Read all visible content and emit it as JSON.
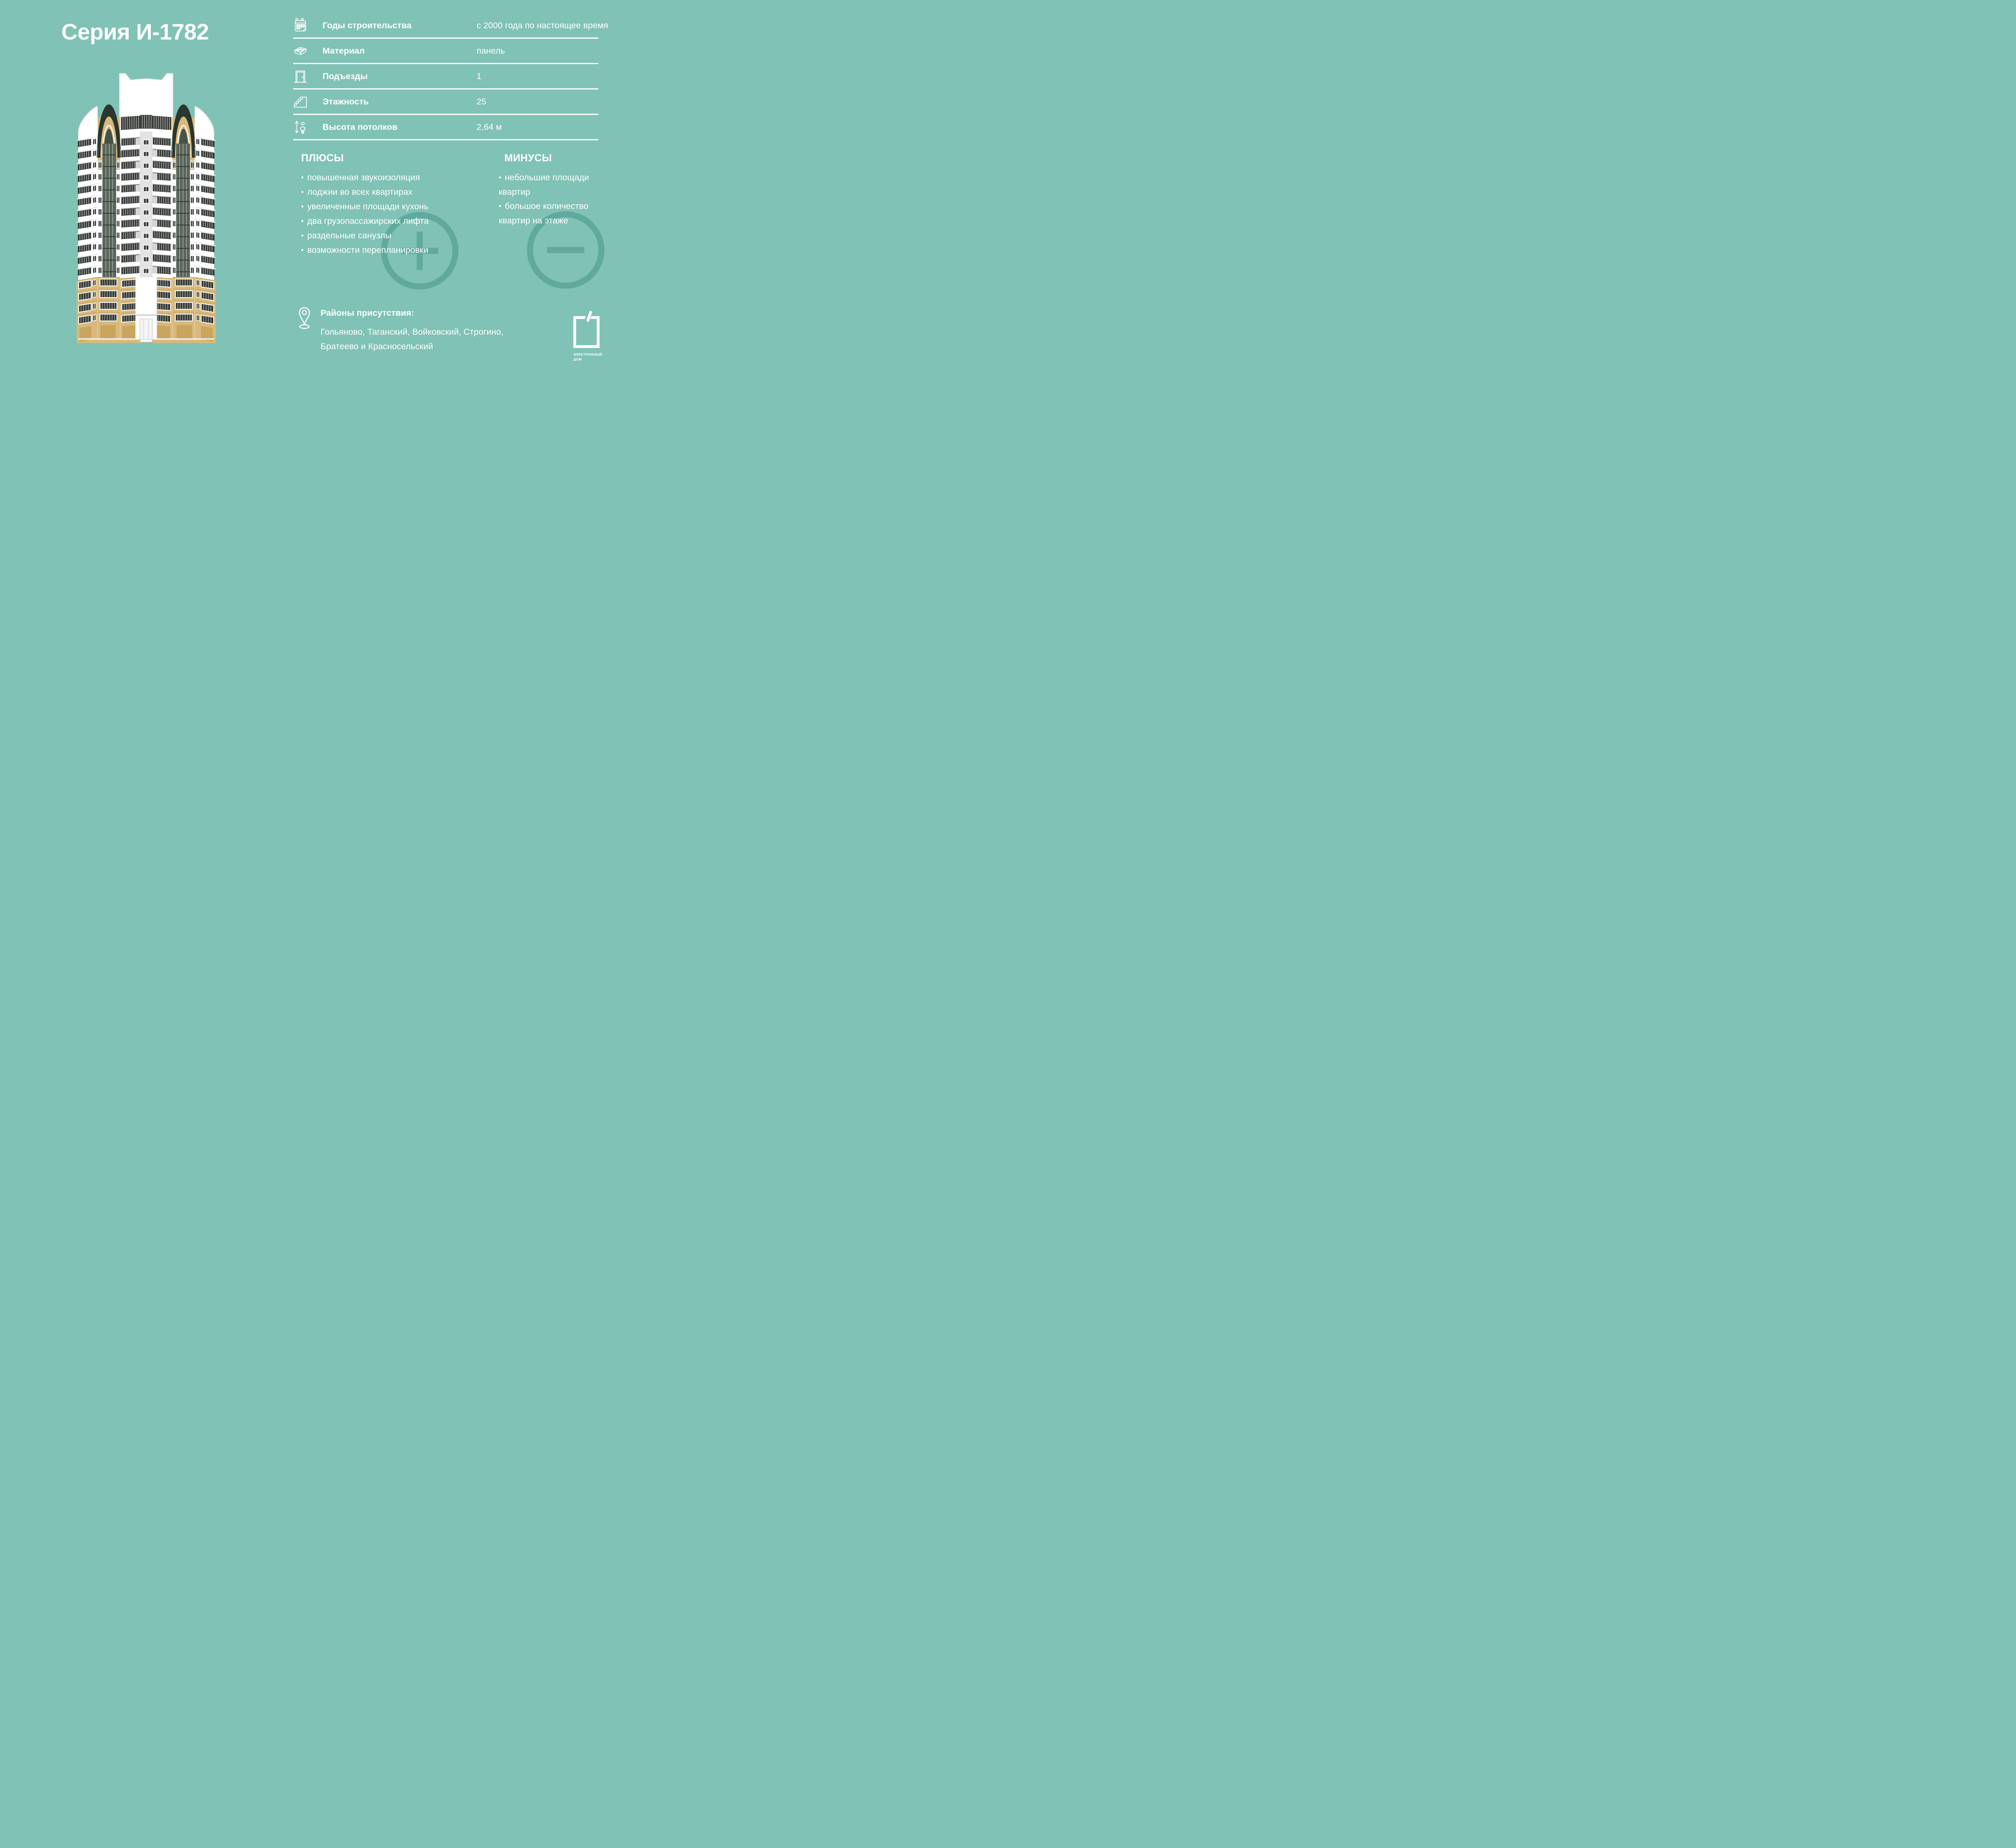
{
  "title": "Серия И-1782",
  "specs": {
    "rows": [
      {
        "icon": "calendar-icon",
        "label": "Годы строительства",
        "value": "с 2000 года по настоящее время"
      },
      {
        "icon": "brick-icon",
        "label": "Материал",
        "value": "панель"
      },
      {
        "icon": "door-icon",
        "label": "Подъезды",
        "value": "1"
      },
      {
        "icon": "stairs-icon",
        "label": "Этажность",
        "value": "25"
      },
      {
        "icon": "ceiling-height-icon",
        "label": "Высота потолков",
        "value": "2,64 м"
      }
    ]
  },
  "pros": {
    "heading": "ПЛЮСЫ",
    "bullet": "•",
    "items": [
      "повышенная звукоизоляция",
      "лоджии во всех квартирах",
      "увеличенные площади кухонь",
      "два грузопассажирских лифта",
      "раздельные санузлы",
      "возможности перепланировки"
    ]
  },
  "cons": {
    "heading": "МИНУСЫ",
    "bullet": "•",
    "items": [
      "небольшие площади квартир",
      "большое количество квартир на этаже"
    ]
  },
  "districts": {
    "heading": "Районы присутствия:",
    "lines": [
      "Гольяново, Таганский, Войковский, Строгино,",
      "Братеево и Красносельский"
    ]
  },
  "logo": {
    "line1": "ЭЛЕКТРОННЫЙ",
    "line2": "ДОМ"
  },
  "colors": {
    "background": "#80c2b5",
    "accent_circle": "#61a99d",
    "text": "#ffffff",
    "building": {
      "wall": "#ffffff",
      "window": "#3a3e3a",
      "loggia": "#5a665c",
      "loggia_grid": "#2c3a2e",
      "tan": "#d8b97c",
      "tan_dark": "#c7a461",
      "arch": "#2a362e",
      "arch_glass": "#46534a",
      "gray": "#e3e3e3",
      "line": "#d9d9d9",
      "spandrel": "#d6d6d6",
      "door_tan": "#c9a55e",
      "mullion": "#ffffff"
    }
  }
}
